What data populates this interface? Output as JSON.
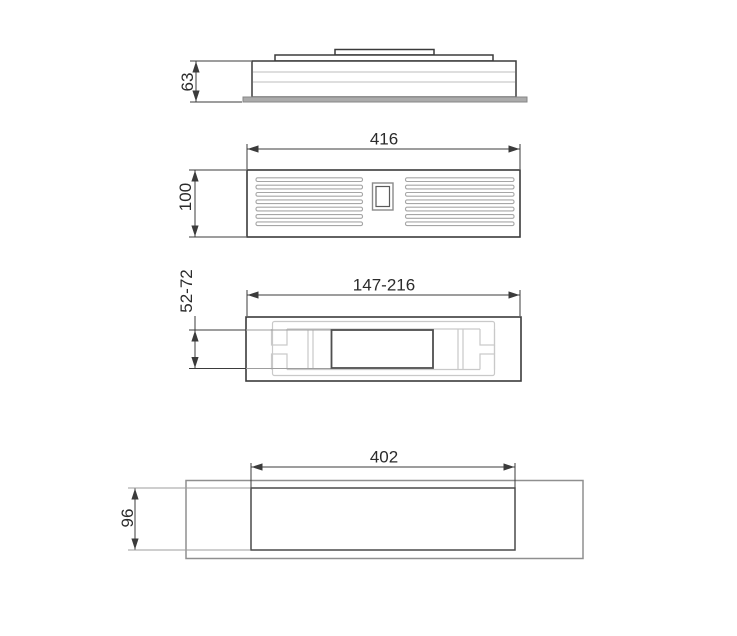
{
  "drawing": {
    "type": "technical-dimension-drawing",
    "views": [
      {
        "id": "side-profile",
        "dims": [
          {
            "label": "63",
            "measures": "height",
            "orientation": "vertical"
          }
        ]
      },
      {
        "id": "front-grille",
        "dims": [
          {
            "label": "416",
            "measures": "width",
            "orientation": "horizontal"
          },
          {
            "label": "100",
            "measures": "height",
            "orientation": "vertical"
          }
        ]
      },
      {
        "id": "mounting-bracket-top",
        "dims": [
          {
            "label": "147-216",
            "measures": "width-range",
            "orientation": "horizontal"
          },
          {
            "label": "52-72",
            "measures": "height-range",
            "orientation": "vertical"
          }
        ]
      },
      {
        "id": "recess-cutout",
        "dims": [
          {
            "label": "402",
            "measures": "width",
            "orientation": "horizontal"
          },
          {
            "label": "96",
            "measures": "height",
            "orientation": "vertical"
          }
        ]
      }
    ]
  },
  "colors": {
    "line": "#3b3b3b",
    "light": "#c9c9c9",
    "mid": "#a6a6a6",
    "flange": "#ababab",
    "text": "#2b2b2b",
    "background": "#ffffff"
  }
}
